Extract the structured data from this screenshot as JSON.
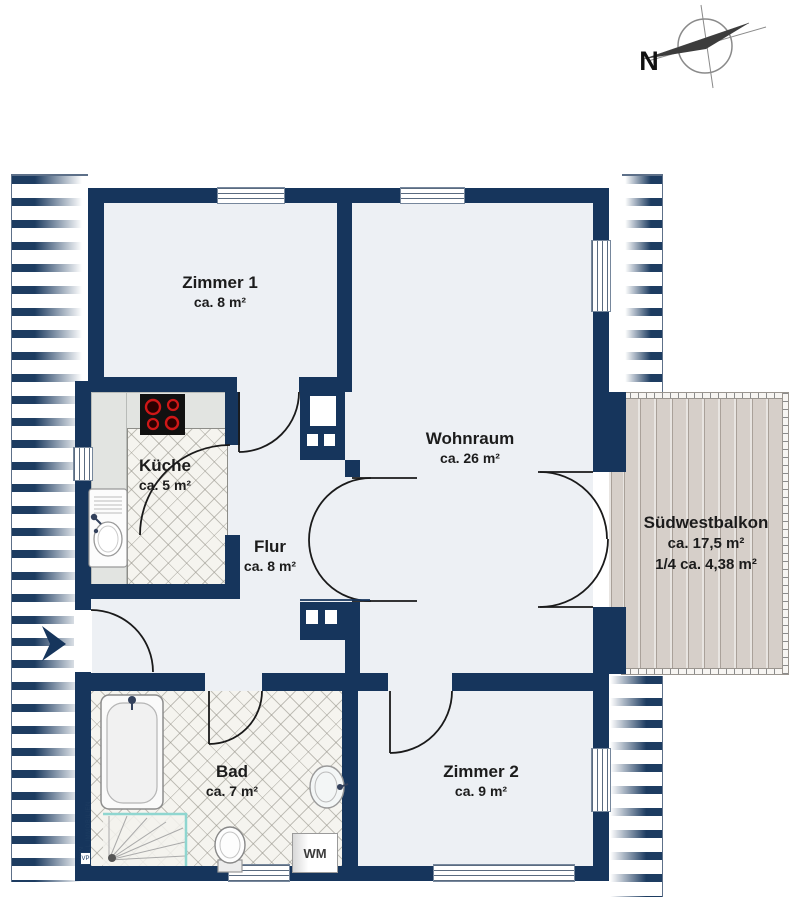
{
  "plan": {
    "compass_label": "N"
  },
  "rooms": [
    {
      "id": "zimmer1",
      "name": "Zimmer 1",
      "area": "ca. 8 m²"
    },
    {
      "id": "kueche",
      "name": "Küche",
      "area": "ca. 5 m²"
    },
    {
      "id": "flur",
      "name": "Flur",
      "area": "ca. 8 m²"
    },
    {
      "id": "wohnraum",
      "name": "Wohnraum",
      "area": "ca. 26 m²"
    },
    {
      "id": "bad",
      "name": "Bad",
      "area": "ca. 7 m²"
    },
    {
      "id": "zimmer2",
      "name": "Zimmer 2",
      "area": "ca. 9 m²"
    },
    {
      "id": "balkon",
      "name": "Südwestbalkon",
      "area": "ca. 17,5 m²",
      "area2": "1/4 ca. 4,38 m²"
    }
  ],
  "fixtures": {
    "washing_machine_label": "WM"
  },
  "watermark": {
    "line1": "VON POLL",
    "line2": "IMMOBILIEN",
    "logo": "VP"
  },
  "colors": {
    "wall": "#16355c",
    "floor": "#edf0f4",
    "tile": "#f5f4ef",
    "wood": "#d6cfc9",
    "shower_accent": "#8fd6d0",
    "burner_red": "#cf1717"
  }
}
